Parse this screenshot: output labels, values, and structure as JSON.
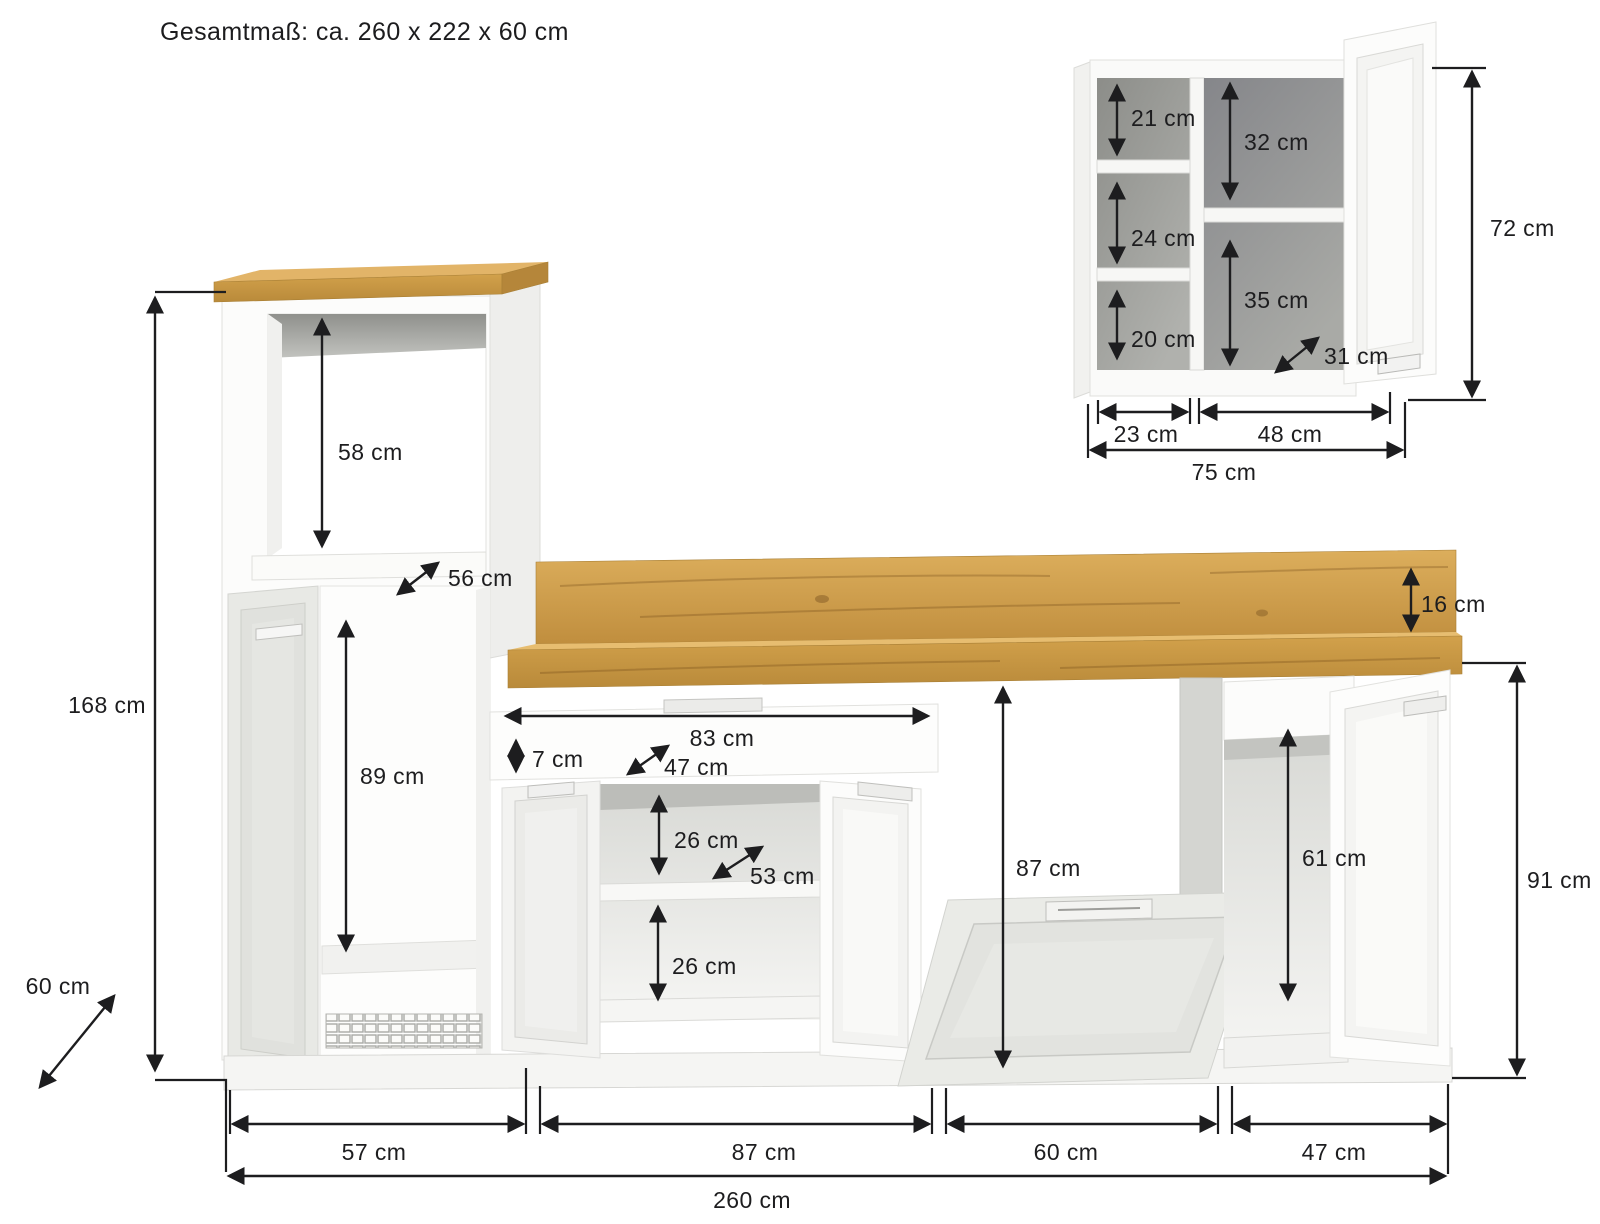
{
  "title": "Gesamtmaß: ca. 260 x 222 x 60 cm",
  "main": {
    "d168": "168 cm",
    "d60_depth": "60 cm",
    "d58": "58 cm",
    "d56": "56 cm",
    "d89": "89 cm",
    "d83": "83 cm",
    "d7": "7 cm",
    "d47_inner": "47 cm",
    "d26_upper": "26 cm",
    "d53": "53 cm",
    "d26_lower": "26 cm",
    "d16": "16 cm",
    "d87_height": "87 cm",
    "d61": "61 cm",
    "d91": "91 cm",
    "d57": "57 cm",
    "d87_width": "87 cm",
    "d60_width": "60 cm",
    "d47_width": "47 cm",
    "d260": "260 cm"
  },
  "wall_cabinet": {
    "d21": "21 cm",
    "d32": "32 cm",
    "d24": "24 cm",
    "d35": "35 cm",
    "d20": "20 cm",
    "d31": "31 cm",
    "d23": "23 cm",
    "d48": "48 cm",
    "d75": "75 cm",
    "d72": "72 cm"
  }
}
